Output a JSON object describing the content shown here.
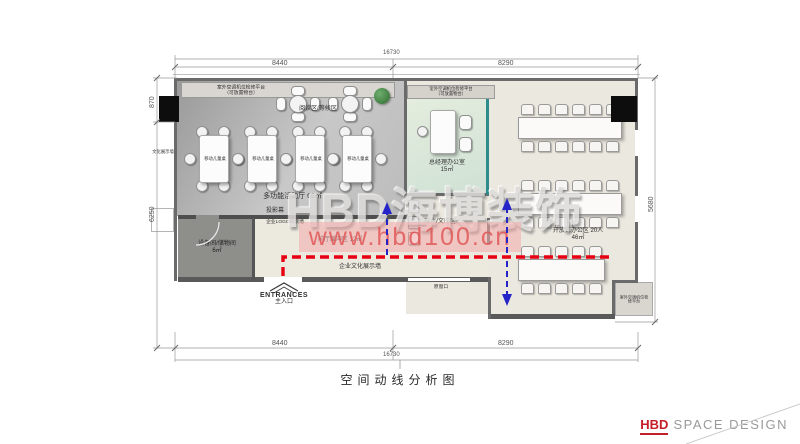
{
  "title": "空间动线分析图",
  "watermark": {
    "brand": "HBD海博装饰",
    "site": "www.hbd100.cn"
  },
  "footer": {
    "brand": "HBD",
    "text": "SPACE DESIGN"
  },
  "labels": {
    "ac_line1": "室外空调机位检修平台",
    "ac_line2": "（可放置物台）",
    "ac_short": "室外空调机位检修平台",
    "reading": "阅读区/等候区",
    "kids": "移动儿童桌",
    "culture_left": "文化展示墙",
    "hall": "多功能活动厅  69㎡",
    "screen": "投影幕",
    "logo_wall": "企业LOGO背景墙",
    "buffer": "前厅缓冲区  12㎡",
    "culture_wall": "企业文化展示墙",
    "equip_name": "设备间/储物间",
    "equip_area": "6㎡",
    "entrance_en": "ENTRANCES",
    "entrance_zh": "主入口",
    "window": "原窗口",
    "manager_name": "总经理办公室",
    "manager_area": "15㎡",
    "tea": "茶水/文印区",
    "office_name": "开放式办公区  20人",
    "office_area": "46㎡"
  },
  "dimensions": {
    "top_left": "8440",
    "top_right": "8290",
    "top_total": "16730",
    "bottom_left": "8440",
    "bottom_right": "8290",
    "bottom_total": "16730",
    "left_upper": "870",
    "left_lower": "6250",
    "right_side": "5680"
  },
  "colors": {
    "route_red": "#e60012",
    "route_blue": "#2424c8",
    "partition_teal": "#2e8b8b",
    "watermark_pink": "#f3aaaa",
    "brand_red": "#c41e28"
  }
}
